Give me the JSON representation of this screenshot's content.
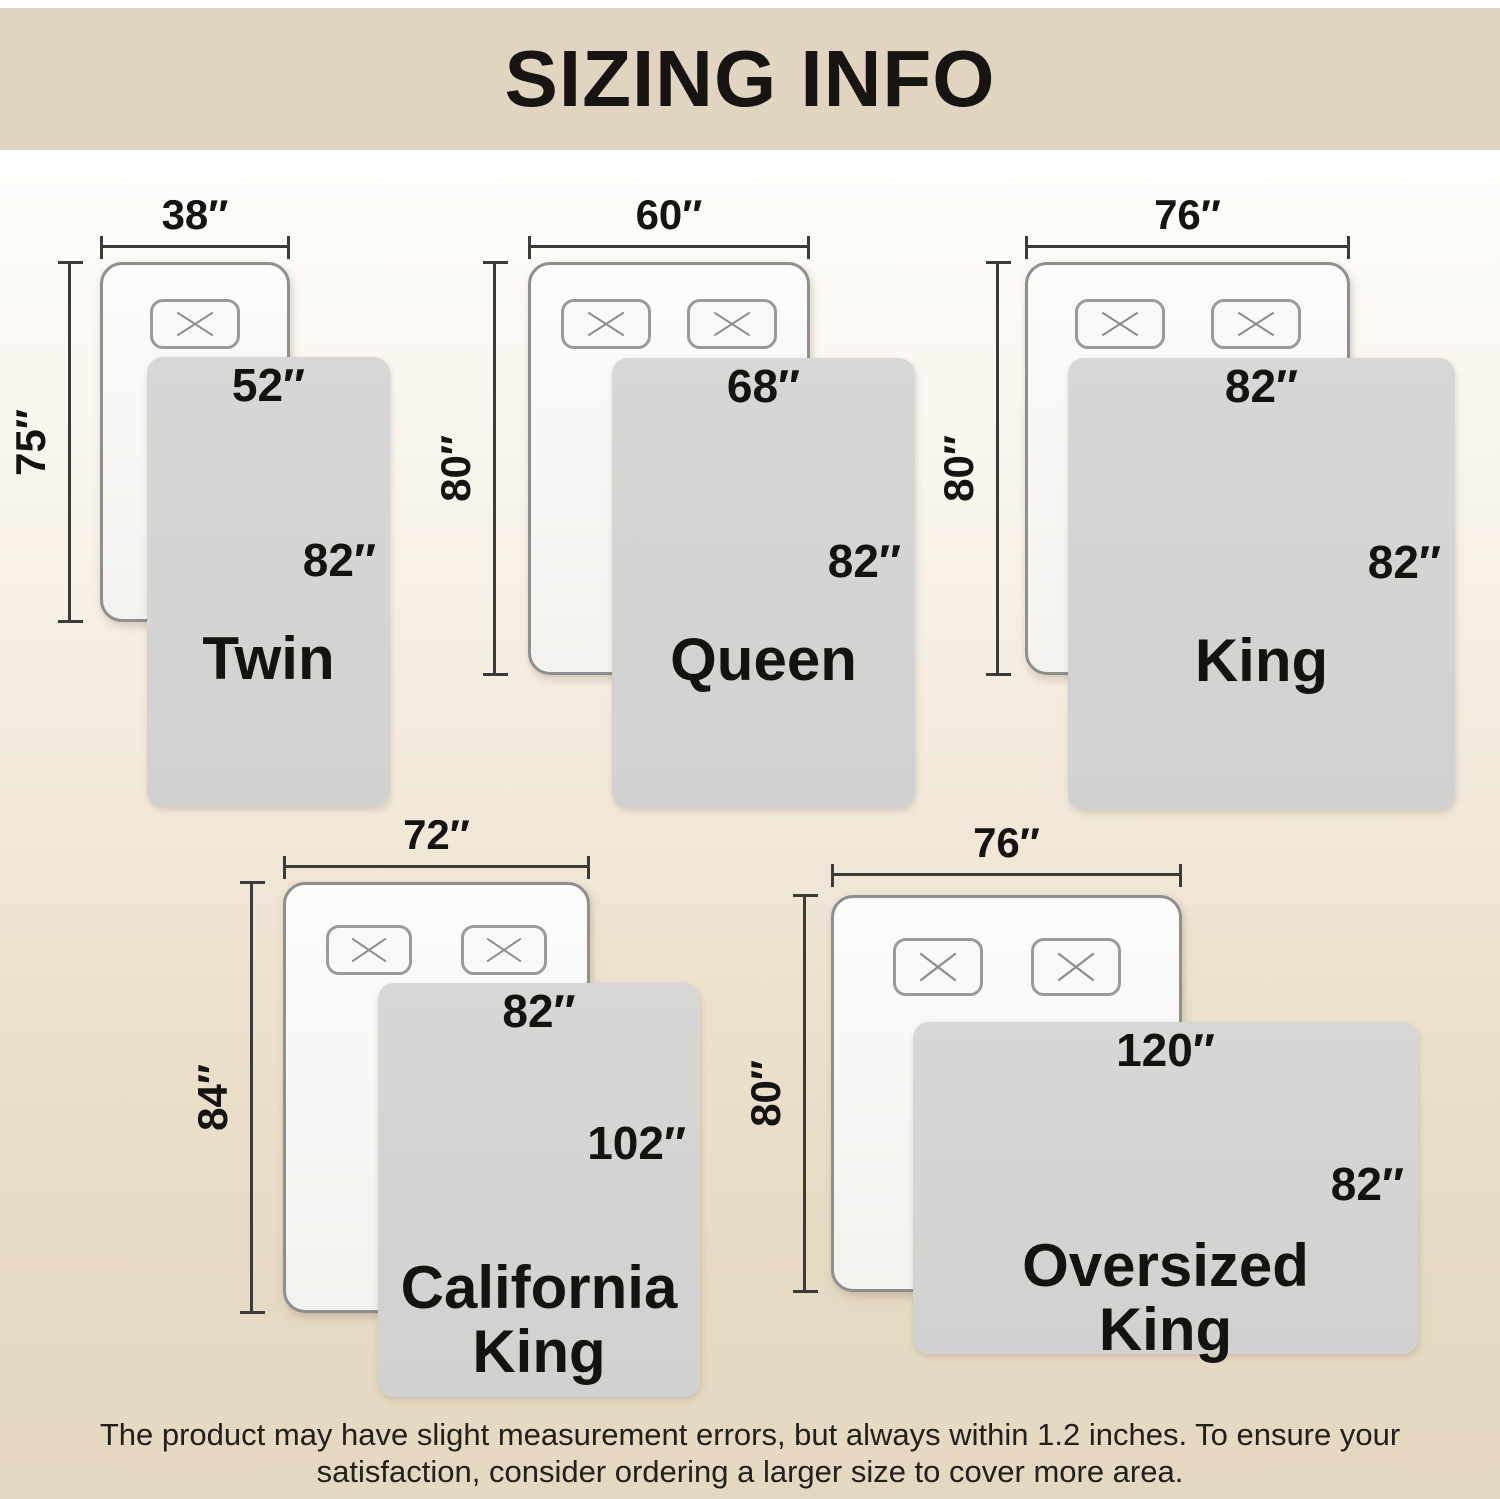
{
  "header": {
    "title": "SIZING INFO"
  },
  "sizes": [
    {
      "name": "Twin",
      "bed_width": "38″",
      "bed_length": "75″",
      "blanket_width": "52″",
      "blanket_length": "82″",
      "pillows": 1
    },
    {
      "name": "Queen",
      "bed_width": "60″",
      "bed_length": "80″",
      "blanket_width": "68″",
      "blanket_length": "82″",
      "pillows": 2
    },
    {
      "name": "King",
      "bed_width": "76″",
      "bed_length": "80″",
      "blanket_width": "82″",
      "blanket_length": "82″",
      "pillows": 2
    },
    {
      "name": "California King",
      "bed_width": "72″",
      "bed_length": "84″",
      "blanket_width": "82″",
      "blanket_length": "102″",
      "pillows": 2
    },
    {
      "name": "Oversized King",
      "bed_width": "76″",
      "bed_length": "80″",
      "blanket_width": "120″",
      "blanket_length": "82″",
      "pillows": 2
    }
  ],
  "footer": {
    "line1": "The product may have slight measurement errors, but always within 1.2 inches. To ensure your",
    "line2": "satisfaction, consider ordering a larger size to cover more area."
  },
  "colors": {
    "header_bg": "#e1d4c1",
    "page_gradient_top": "#ffffff",
    "page_gradient_bottom": "#e5d8c2",
    "blanket_fill": "#d5d5d4",
    "bed_fill": "#f8f7f4",
    "bed_border": "#8f8f8f",
    "pillow_border": "#9a9a9a",
    "dimension_line": "#3b3b3b",
    "text": "#171411"
  }
}
